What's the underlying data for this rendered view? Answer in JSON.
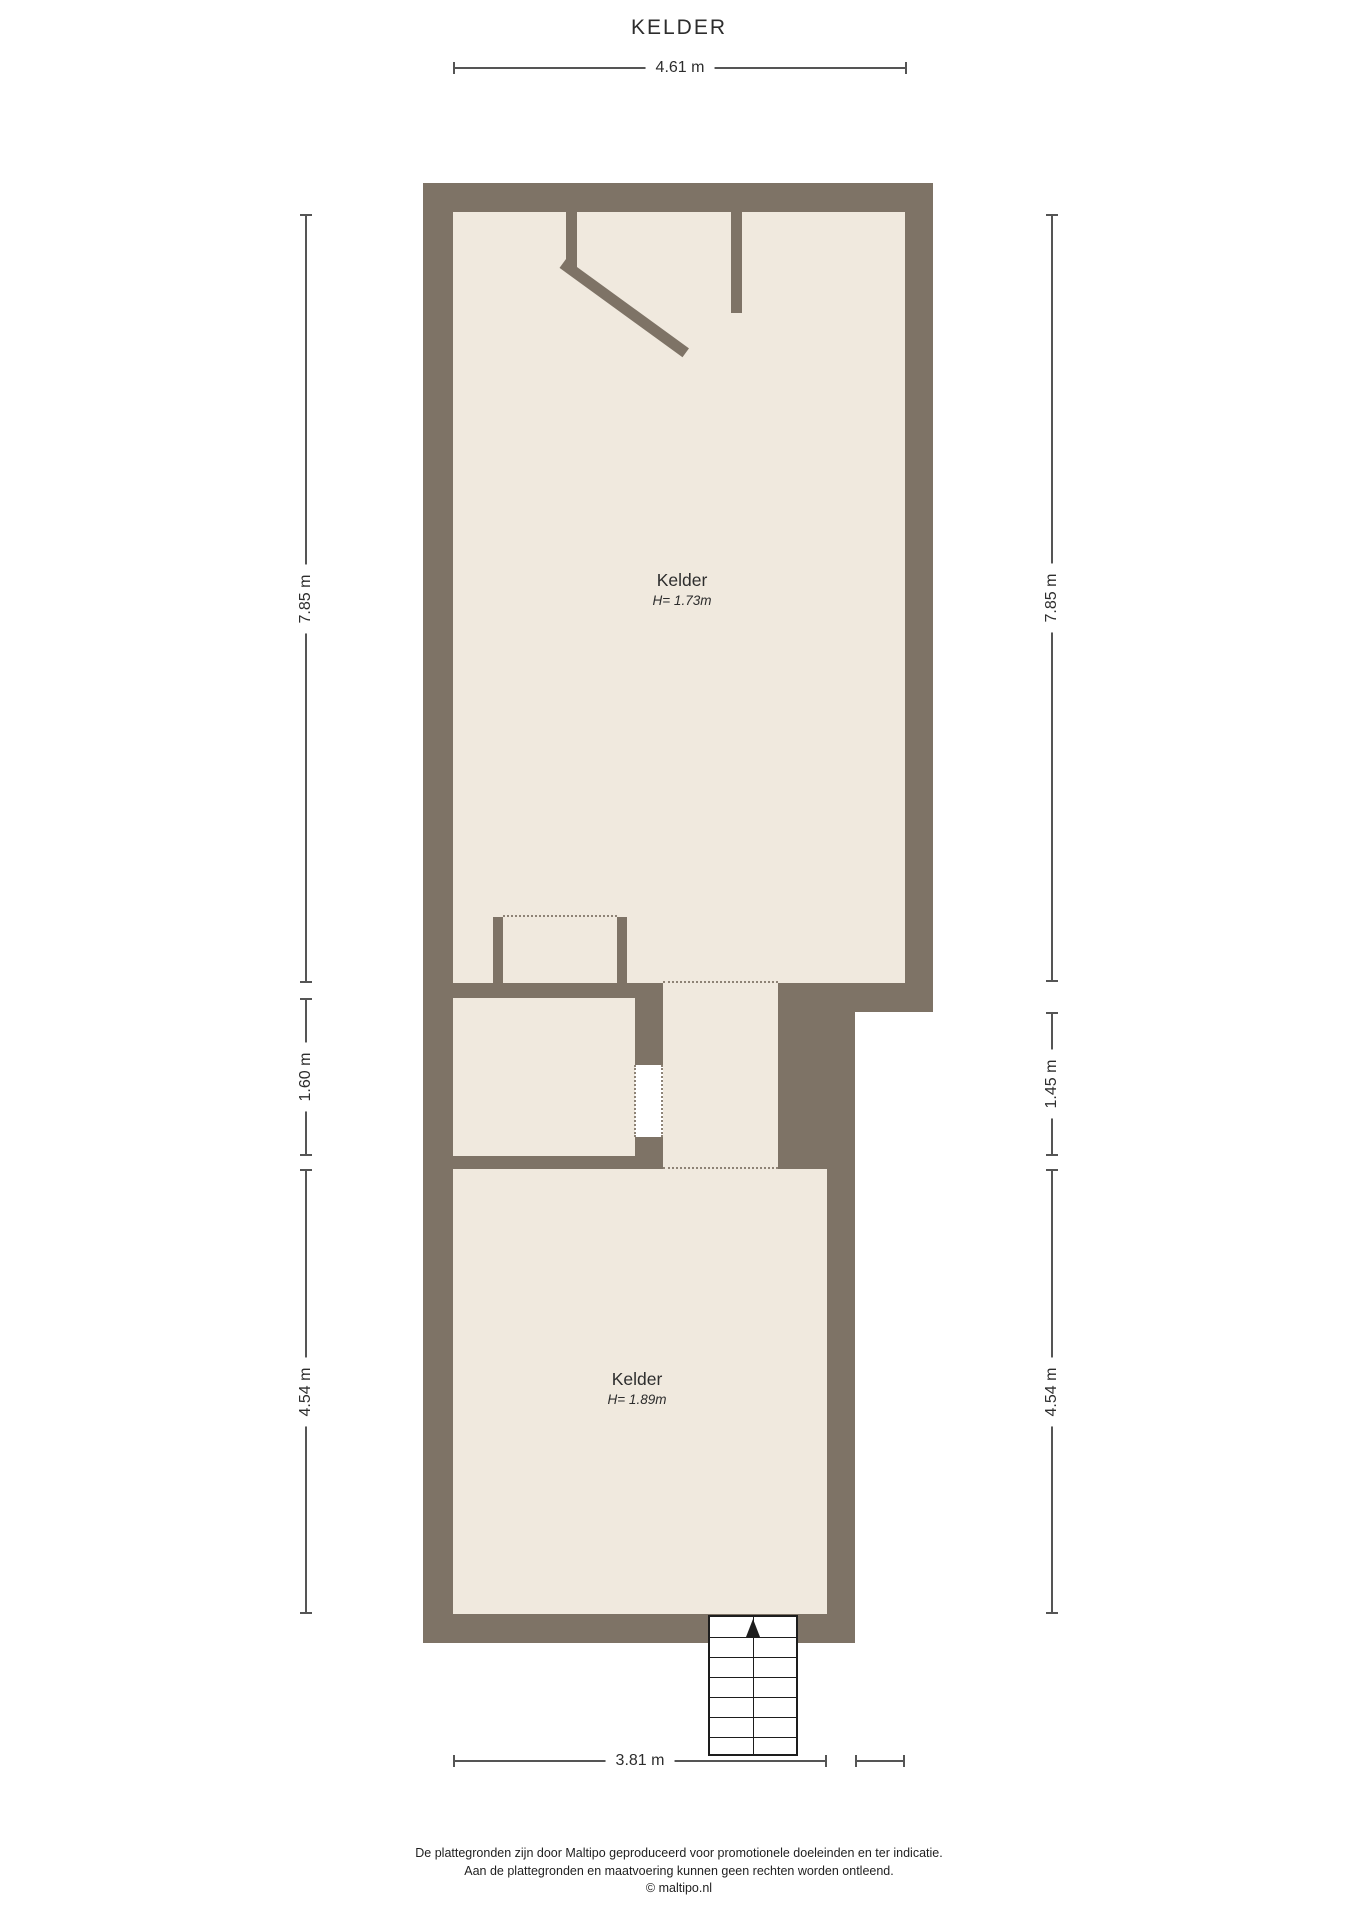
{
  "title": "KELDER",
  "rooms": {
    "upper": {
      "name": "Kelder",
      "height": "H= 1.73m"
    },
    "lower": {
      "name": "Kelder",
      "height": "H= 1.89m"
    }
  },
  "dimensions": {
    "top": "4.61 m",
    "bottom": "3.81 m",
    "left_top": "7.85 m",
    "left_mid": "1.60 m",
    "left_bottom": "4.54 m",
    "right_top": "7.85 m",
    "right_mid": "1.45 m",
    "right_bottom": "4.54 m"
  },
  "stairs": {
    "steps": 7,
    "direction": "up"
  },
  "icons": {
    "stairs_arrow": "up-arrow-icon"
  },
  "footer": {
    "line1": "De plattegronden zijn door Maltipo geproduceerd voor promotionele doeleinden en ter indicatie.",
    "line2": "Aan de plattegronden en maatvoering kunnen geen rechten worden ontleend.",
    "line3": "© maltipo.nl"
  },
  "colors": {
    "wall": "#7e7366",
    "floor": "#f0e9de",
    "dashed": "#8e8376",
    "dim": "#555555",
    "text": "#2d2d2d",
    "stairs": "#1d1d1d"
  }
}
